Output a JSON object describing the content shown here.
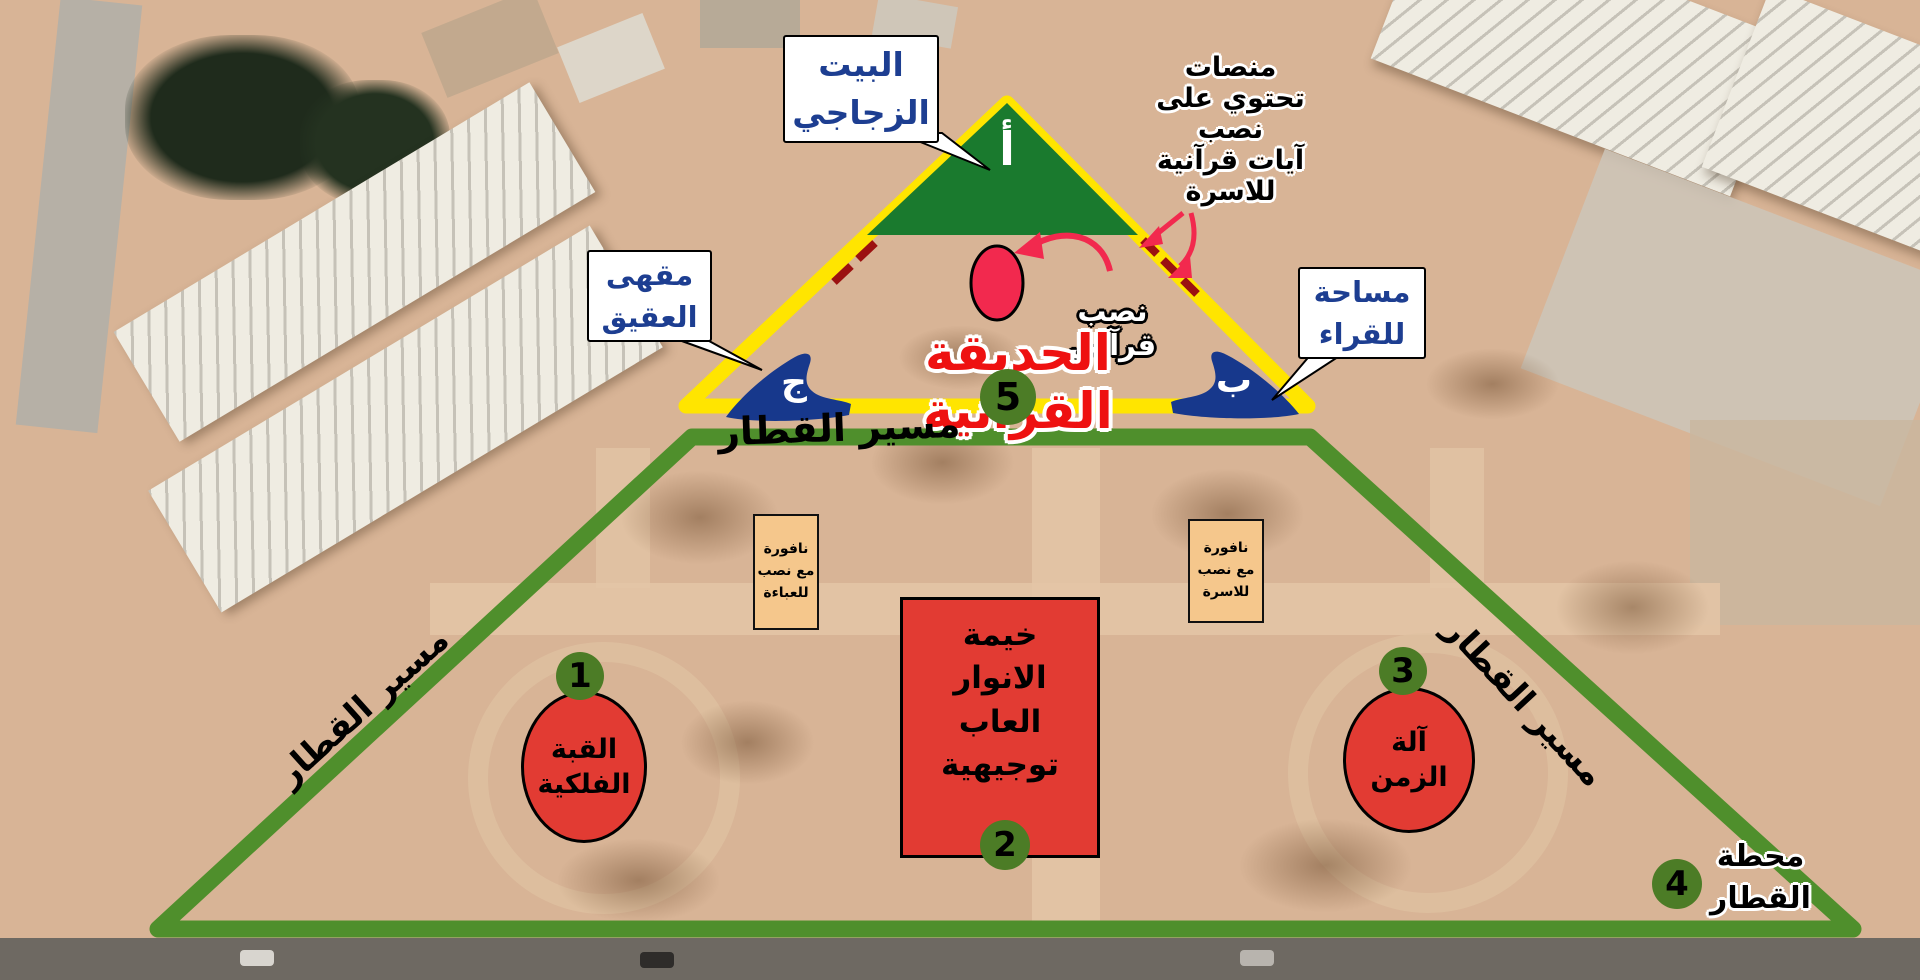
{
  "title": {
    "text": "الحديقة القرآنية",
    "number": "5"
  },
  "zones": {
    "a": "أ",
    "b": "ب",
    "j": "ج"
  },
  "callouts": {
    "glass_house": {
      "lines": [
        "البيت",
        "الزجاجي"
      ]
    },
    "cafe": {
      "lines": [
        "مقهى",
        "العقيق"
      ]
    },
    "reading_area": {
      "lines": [
        "مساحة",
        "للقراء"
      ]
    }
  },
  "annotations": {
    "platforms": {
      "lines": [
        "منصات",
        "تحتوي على",
        "نصب",
        "آيات قرآنية",
        "للاسرة"
      ]
    },
    "monument": {
      "text": "نصب قرآني"
    }
  },
  "train": {
    "route_label": "مسير القطار",
    "station": {
      "number": "4",
      "lines": [
        "محطة",
        "القطار"
      ]
    }
  },
  "attractions": {
    "planetarium": {
      "number": "1",
      "lines": [
        "القبة",
        "الفلكية"
      ]
    },
    "tent": {
      "number": "2",
      "lines": [
        "خيمة",
        "الانوار",
        "العاب",
        "توجيهية"
      ]
    },
    "time_machine": {
      "number": "3",
      "lines": [
        "آلة",
        "الزمن"
      ]
    }
  },
  "fountains": {
    "abaya": {
      "lines": [
        "نافورة",
        "مع نصب",
        "للعباءة"
      ]
    },
    "family": {
      "lines": [
        "نافورة",
        "مع نصب",
        "للاسرة"
      ]
    }
  },
  "colors": {
    "boundary_yellow": "#ffe500",
    "glass_house_green": "#1a7a2e",
    "train_route_green": "#4f8f2c",
    "marker_green": "#4c7c26",
    "attraction_red": "#e23b33",
    "monument_red": "#f2294e",
    "title_red": "#ee1111",
    "label_blue": "#1d3e91",
    "fountain_tan": "#f5c78c",
    "dash_red": "#9b1111"
  }
}
